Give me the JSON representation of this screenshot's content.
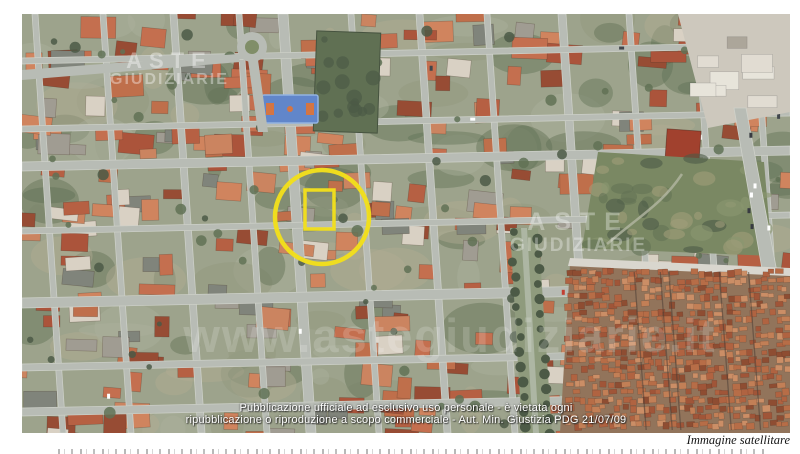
{
  "page": {
    "background": "#ffffff"
  },
  "image_caption": "Immagine satellitare",
  "overlay_notice": {
    "line1": "Pubblicazione ufficiale ad esclusivo uso personale - è vietata ogni",
    "line2": "ripubblicazione o riproduzione a scopo commerciale - Aut. Min. Giustizia PDG 21/07/09",
    "color": "#ffffff"
  },
  "watermarks": {
    "brand_top_left": {
      "line1": "ASTE",
      "line2": "GIUDIZIARIE"
    },
    "brand_center_right": {
      "line1": "ASTE",
      "line2": "GIUDIZIARIE"
    },
    "website_banner": "www.astegiudiziarie.it"
  },
  "annotation": {
    "type": "property-highlight",
    "color": "#f2df1c",
    "circle": {
      "cx": 300,
      "cy": 203,
      "r": 47,
      "stroke_width": 4.5
    },
    "rect": {
      "x": 283,
      "y": 176,
      "w": 29,
      "h": 39,
      "stroke_width": 3.5
    }
  },
  "map": {
    "type": "satellite",
    "palette": {
      "ground": "#99a088",
      "road": "#b6bab2",
      "road_edge": "#cdd0c8",
      "roofs": [
        "#b35a3c",
        "#c26a48",
        "#a84e33",
        "#cf7f58",
        "#93452c",
        "#c97f5a",
        "#bd6a44",
        "#d8d0c2",
        "#9d988e",
        "#7b7f76"
      ],
      "old_town_base": "#8e6f55",
      "old_town_roofs": [
        "#ad5d3a",
        "#9d4f30",
        "#c07a50",
        "#8a462a",
        "#c98a60",
        "#b56840"
      ],
      "tree_dark": "#45543f",
      "tree_mid": "#5b6c4f",
      "green_field": "#5a6b4d",
      "scrub": "#75845d",
      "boulevard": "#8b9778",
      "court_blue": "#5b82c8",
      "court_markings": "#d3703c",
      "white_zone": "#cbc6bb",
      "slab_light": "#e7e3d9",
      "slab_dark": "#a9a396",
      "red_building": "#9e3a26",
      "haze": "#ffffff"
    }
  }
}
